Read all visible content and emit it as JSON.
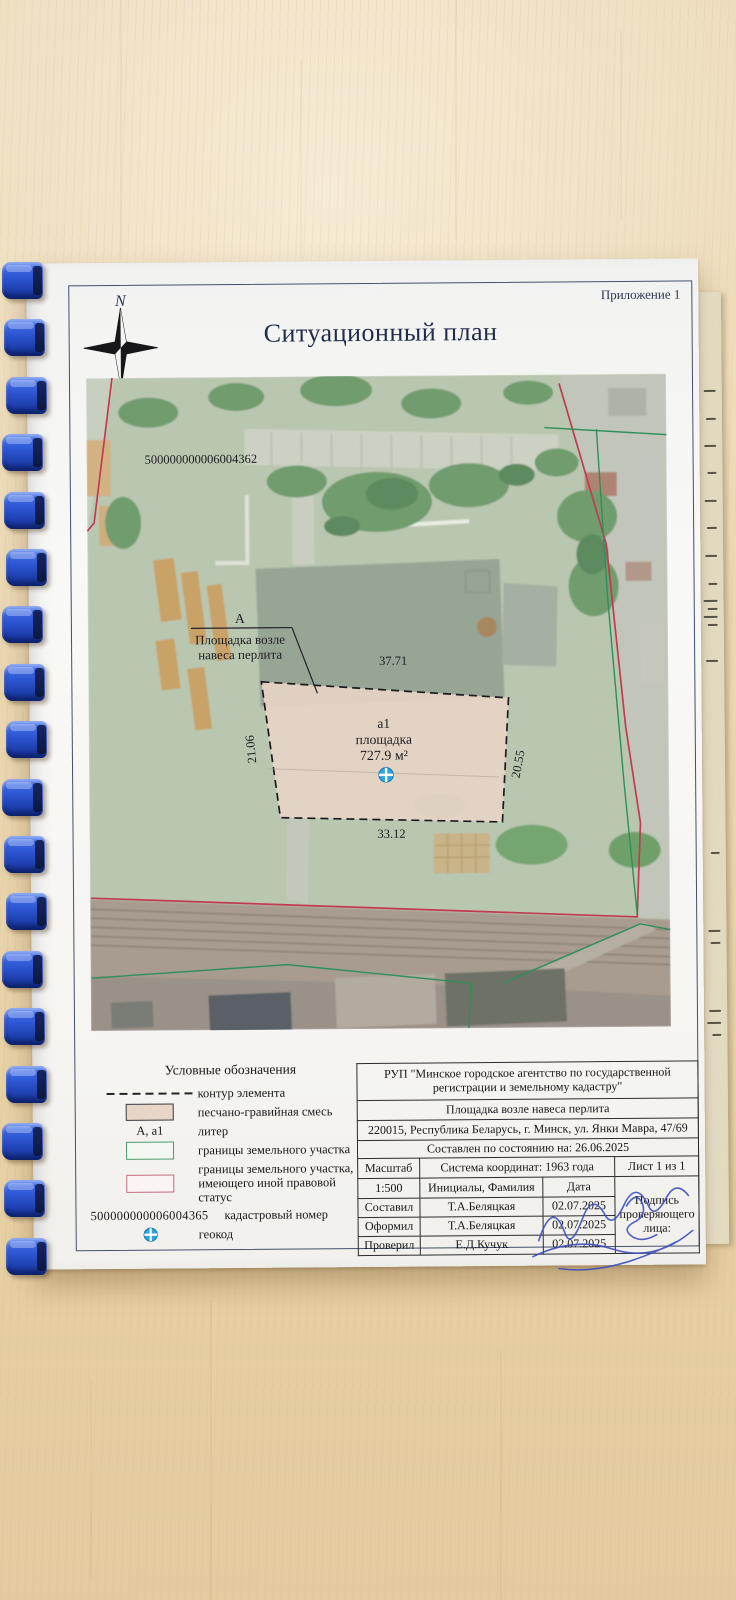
{
  "photo": {
    "annex_label": "Приложение 1",
    "title": "Ситуационный план",
    "compass": {
      "north": "N",
      "south": "S"
    }
  },
  "map": {
    "cadastral_number": "500000000006004362",
    "site_callout": {
      "letter": "А",
      "line1": "Площадка возле",
      "line2": "навеса перлита"
    },
    "parcel": {
      "litera": "а1",
      "name": "площадка",
      "area": "727.9 м²",
      "dim_top": "37.71",
      "dim_bottom": "33.12",
      "dim_left": "21.06",
      "dim_right": "20.55"
    }
  },
  "legend": {
    "heading": "Условные обозначения",
    "items": [
      {
        "type": "dashed-line",
        "label": "контур элемента"
      },
      {
        "type": "fill-swatch",
        "label": "песчано-гравийная смесь"
      },
      {
        "type": "letter-text",
        "swatch_text": "А, а1",
        "label": "литер"
      },
      {
        "type": "outline-green",
        "label": "границы земельного участка"
      },
      {
        "type": "outline-red",
        "label": "границы земельного участка, имеющего иной правовой статус"
      },
      {
        "type": "number-text",
        "swatch_text": "500000000006004365",
        "label": "кадастровый номер"
      },
      {
        "type": "geocode",
        "label": "геокод"
      }
    ]
  },
  "title_block": {
    "organization": "РУП \"Минское городское агентство по государственной регистрации и земельному кадастру\"",
    "object_name": "Площадка возле навеса перлита",
    "address": "220015, Республика Беларусь, г. Минск, ул. Янки Мавра, 47/69",
    "compiled_on": "Составлен по состоянию на: 26.06.2025",
    "scale_label": "Масштаб",
    "scale_value": "1:500",
    "coordinate_system": "Система координат: 1963 года",
    "sheet_info": "Лист 1 из 1",
    "initials_header": "Инициалы, Фамилия",
    "date_header": "Дата",
    "signature_note": "Подпись проверяющего лица:",
    "rows": [
      {
        "role": "Составил",
        "name": "Т.А.Беляцкая",
        "date": "02.07.2025"
      },
      {
        "role": "Оформил",
        "name": "Т.А.Беляцкая",
        "date": "02.07.2025"
      },
      {
        "role": "Проверил",
        "name": "Е.Д.Кучук",
        "date": "02.07.2025"
      }
    ]
  },
  "colors": {
    "boundary_red": "#c23b52",
    "boundary_green": "#2f8f5b",
    "parcel_fill": "#e6d4c5",
    "geocode_blue": "#2aa7df",
    "binding_blue": "#2b53cc",
    "signature_ink": "#3c4fc0",
    "wood_desk": "#ebd7b1"
  }
}
